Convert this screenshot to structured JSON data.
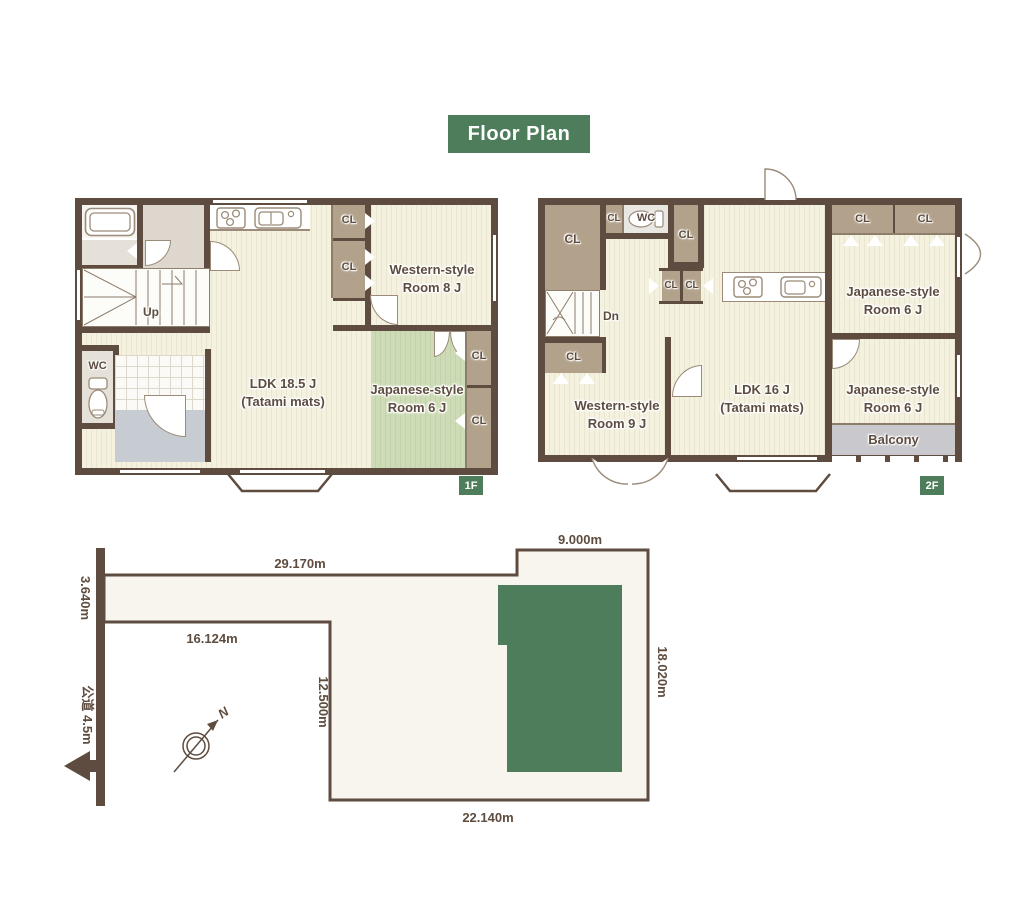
{
  "title": "Floor Plan",
  "labels": {
    "cl": "CL",
    "wc": "WC",
    "up": "Up",
    "dn": "Dn",
    "balcony": "Balcony"
  },
  "floor1": {
    "badge": "1F",
    "ldk_line1": "LDK 18.5 J",
    "ldk_line2": "(Tatami mats)",
    "western_line1": "Western-style",
    "western_line2": "Room 8 J",
    "japanese_line1": "Japanese-style",
    "japanese_line2": "Room 6 J"
  },
  "floor2": {
    "badge": "2F",
    "ldk_line1": "LDK 16 J",
    "ldk_line2": "(Tatami mats)",
    "western_line1": "Western-style",
    "western_line2": "Room 9 J",
    "japanese_top_line1": "Japanese-style",
    "japanese_top_line2": "Room 6 J",
    "japanese_bottom_line1": "Japanese-style",
    "japanese_bottom_line2": "Room 6 J"
  },
  "site": {
    "dim_top": "29.170m",
    "dim_top_right": "9.000m",
    "dim_left": "3.640m",
    "dim_inner_top": "16.124m",
    "dim_inner_left": "12.500m",
    "dim_right": "18.020m",
    "dim_bottom": "22.140m",
    "road": "公道 4.5m",
    "north": "N"
  },
  "colors": {
    "accent_green": "#4e7d5b",
    "wall_brown": "#5d4c3f",
    "tatami_green": "#cddcb6",
    "closet_tan": "#b3a28b",
    "building_green": "#4e7d5b"
  }
}
